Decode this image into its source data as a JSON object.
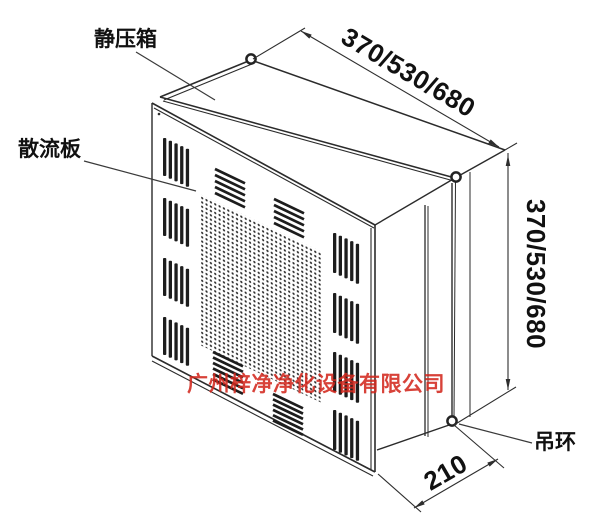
{
  "labels": {
    "plenum_box": "静压箱",
    "diffuser_plate": "散流板",
    "lifting_ring": "吊环"
  },
  "dimensions": {
    "top_width": "370/530/680",
    "right_height": "370/530/680",
    "bottom_depth": "210"
  },
  "watermark": {
    "text": "广州梓净净化设备有限公司",
    "color": "#d3281e"
  },
  "colors": {
    "line": "#2b2b2b",
    "background": "#ffffff"
  }
}
